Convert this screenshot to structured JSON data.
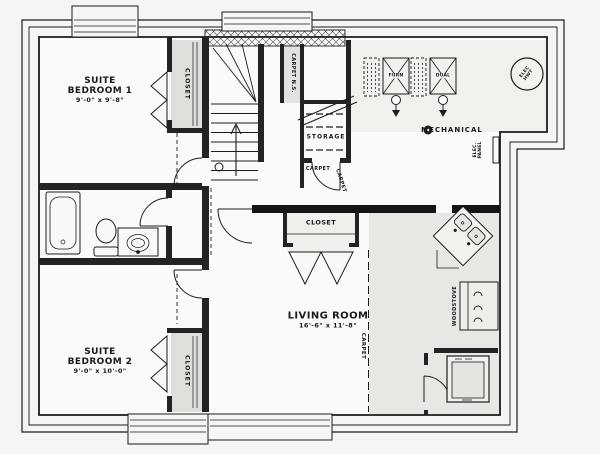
{
  "page": {
    "background": "#f6f5f3",
    "ink": "#1c1c1c",
    "fill_gray": "#e0dedb"
  },
  "rooms": {
    "bedroom1": {
      "name_line1": "SUITE",
      "name_line2": "BEDROOM 1",
      "dims": "9'-0\" x 9'-8\""
    },
    "bedroom2": {
      "name_line1": "SUITE",
      "name_line2": "BEDROOM 2",
      "dims": "9'-0\" x 10'-0\""
    },
    "living_room": {
      "name": "LIVING ROOM",
      "dims": "16'-6\" x 11'-8\""
    },
    "mechanical": {
      "name": "MECHANICAL"
    },
    "storage": {
      "name": "STORAGE"
    }
  },
  "labels": {
    "closet": "CLOSET",
    "carpet": "CARPET",
    "carpet_ns": "CARPET N.S.",
    "elec_panel_line1": "ELEC.",
    "elec_panel_line2": "PANEL",
    "elec_hwt_line1": "ELEC",
    "elec_hwt_line2": "HWT",
    "furnace_unit1": "FURN",
    "furnace_unit2": "DUAL",
    "woodstove": "WOODSTOVE"
  }
}
